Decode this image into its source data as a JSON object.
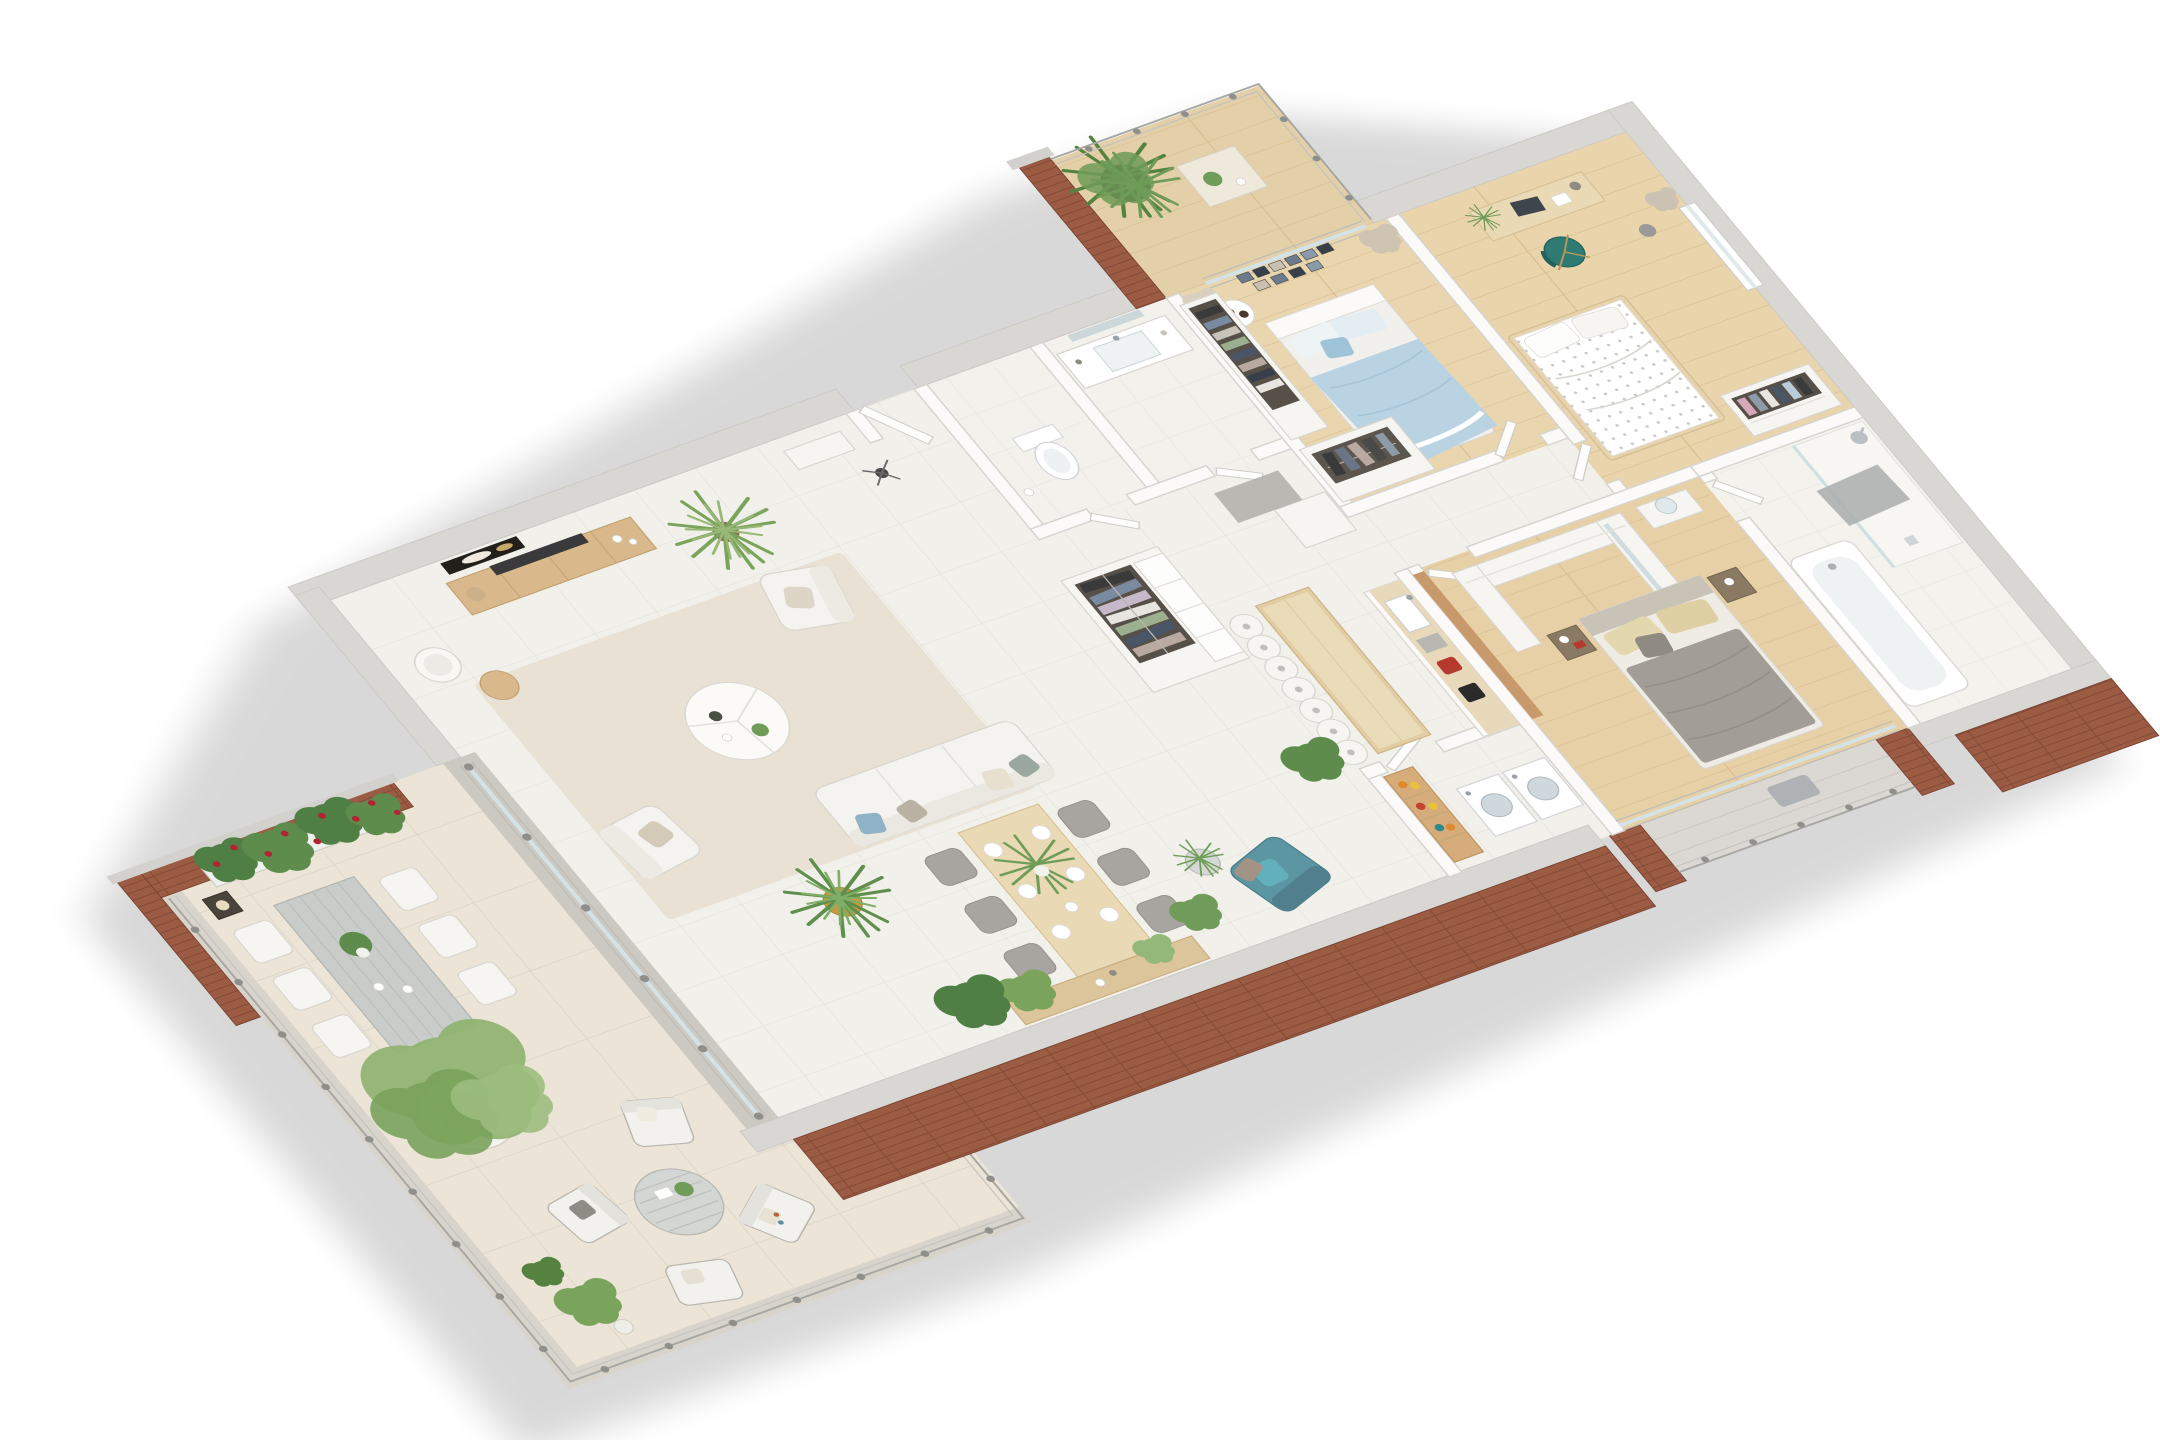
{
  "scene": {
    "title": "Isometric 3D floor plan rendering of a furnished apartment with wrap-around terrace",
    "type": "3d_floor_plan_render",
    "view": "cutaway axonometric from above",
    "background_color": "#ffffff",
    "structure": {
      "exterior_wall_finish": "red-brown brick with gray concrete caps",
      "interior_wall_finish": "white",
      "main_floor_finish": "light beige tile",
      "bedroom_floor_finish": "light oak plank",
      "terrace_floor_finish": "large beige pavers"
    },
    "rooms": [
      {
        "name": "living-room",
        "floor": "light tile",
        "furniture": [
          "wall-art-dark-abstract",
          "tv",
          "tv-console-wood",
          "floor-lamp-drum",
          "tripod-side-stool",
          "palm-plant",
          "area-rug-beige",
          "round-coffee-table-3part",
          "armchair-white-north",
          "armchair-white-west",
          "sofa-white-3seat",
          "yucca-plant-gold-pot",
          "entry-console-table",
          "coat-stand"
        ]
      },
      {
        "name": "dining-area",
        "floor": "light tile",
        "furniture": [
          "dining-table-wood",
          "dining-chairs-gray x6",
          "place-settings x6",
          "centerpiece-plant",
          "storage-bench-wood",
          "monstera-plant",
          "teal-armchair",
          "glass-side-table",
          "potted-plant"
        ]
      },
      {
        "name": "kitchen",
        "floor": "light tile",
        "furniture": [
          "island-bar-wood",
          "bar-stools-white x7",
          "counter-with-sink",
          "coffee-machine-black",
          "toaster-red",
          "tall-cabinet-white",
          "wood-backsplash-panel"
        ]
      },
      {
        "name": "laundry-closet",
        "floor": "light tile",
        "furniture": [
          "washing-machine",
          "dryer",
          "pantry-shelf-with-jars"
        ]
      },
      {
        "name": "hallway",
        "floor": "light tile",
        "furniture": [
          "open-wardrobe-with-clothes",
          "drawer-unit-white",
          "gray-floor-mat",
          "potted-plant"
        ]
      },
      {
        "name": "toilet-room",
        "floor": "pale tile",
        "furniture": [
          "toilet"
        ]
      },
      {
        "name": "bathroom-small",
        "floor": "pale tile",
        "furniture": [
          "vanity-sink",
          "wall-mirror"
        ]
      },
      {
        "name": "bedroom-blue",
        "floor": "oak plank",
        "furniture": [
          "double-bed-blue-duvet",
          "photo-gallery-wall",
          "round-bedside-table",
          "open-wardrobe-with-clothes",
          "low-wardrobe-rail",
          "curtains",
          "sliding-glass-door"
        ]
      },
      {
        "name": "balcony-north",
        "floor": "oak plank",
        "furniture": [
          "large-potted-plant",
          "bistro-table",
          "metal-railing",
          "brick-side-wall"
        ]
      },
      {
        "name": "bedroom-second",
        "floor": "oak plank",
        "furniture": [
          "desk-with-laptop",
          "desk-lamp",
          "office-chair-teal",
          "waste-bin",
          "bed-white-patterned-duvet",
          "open-wardrobe-with-clothes",
          "window-with-curtain"
        ]
      },
      {
        "name": "bedroom-master",
        "floor": "oak plank",
        "furniture": [
          "double-bed-gray-duvet",
          "nightstand-brown x2",
          "walk-in-closet-U",
          "vanity-with-round-mirror",
          "sliding-glass-door-south"
        ]
      },
      {
        "name": "bathroom-master",
        "floor": "pale tile",
        "furniture": [
          "bathtub",
          "walk-in-shower-glass",
          "shower-head",
          "gray-bath-mat"
        ]
      },
      {
        "name": "balcony-master",
        "floor": "concrete pavers",
        "furniture": [
          "metal-railing",
          "brick-piers x2",
          "gray-towel"
        ]
      },
      {
        "name": "terrace",
        "floor": "beige pavers",
        "furniture": [
          "brick-wall-with-rose-planter",
          "metal-lantern",
          "outdoor-dining-table-gray",
          "outdoor-chairs-white x6",
          "table-centerpiece-plant",
          "large-potted-tree",
          "lounge-armchair x3",
          "lounge-ottoman",
          "round-slatted-coffee-table",
          "small-potted-plants x3",
          "glass-steel-railing"
        ]
      }
    ],
    "palette": {
      "brick": "#9c5b43",
      "brick_shadow": "#7c4534",
      "wall_top_gray": "#d9d7d3",
      "interior_wall": "#fbfaf8",
      "tile_floor": "#f2f0ea",
      "terrace_floor": "#ece5d7",
      "oak_floor": "#ead6ae",
      "bath_floor": "#f4f2ed",
      "rug": "#e7dfd2",
      "sofa_white": "#f5f3ef",
      "teal_chair": "#5d96a3",
      "teal_pillow": "#63b0bd",
      "blue_duvet": "#b9d3e3",
      "gray_duvet": "#a29d96",
      "beige_pillow": "#e3d7ae",
      "wood_furniture": "#d9b98c",
      "island_wood": "#e2cda4",
      "plant_green": "#6f9c58",
      "plant_green_dark": "#55833f",
      "gold_pot": "#c79a3e",
      "toaster_red": "#b5392c",
      "appliance_white": "#ffffff",
      "railing_metal": "#a6a6a3",
      "shadow": "#00000028"
    }
  }
}
